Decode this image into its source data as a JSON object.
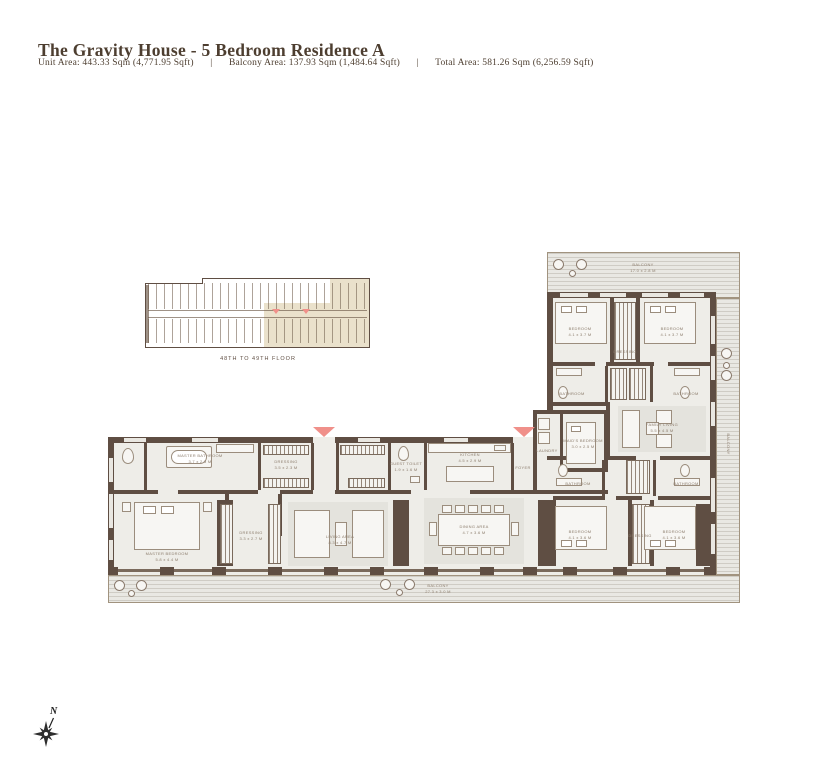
{
  "header": {
    "title": "The Gravity House - 5 Bedroom Residence A",
    "unit_area": "Unit Area: 443.33 Sqm (4,771.95 Sqft)",
    "balcony_area": "Balcony Area: 137.93 Sqm (1,484.64 Sqft)",
    "total_area": "Total Area: 581.26 Sqm (6,256.59 Sqft)",
    "separator": "|"
  },
  "key_plan": {
    "floor_label": "48TH TO 49TH FLOOR"
  },
  "compass": {
    "north_label": "N"
  },
  "colors": {
    "wall_brown": "#5f4e43",
    "entry_marker_pink": "#f0908a",
    "key_plan_highlight": "#eae1cb",
    "floor_fill": "#eeede8",
    "title_text": "#4d3e30",
    "room_label_text": "#8d7e6e"
  },
  "floor_plan": {
    "rooms": [
      {
        "name": "MASTER BATHROOM",
        "dims": "3.7 x 2.3 M"
      },
      {
        "name": "DRESSING",
        "dims": "3.5 x 2.3 M"
      },
      {
        "name": "GUEST TOILET",
        "dims": "1.9 x 1.6 M"
      },
      {
        "name": "KITCHEN",
        "dims": "4.5 x 2.9 M"
      },
      {
        "name": "FOYER",
        "dims": ""
      },
      {
        "name": "MASTER BEDROOM",
        "dims": "5.8 x 4.4 M"
      },
      {
        "name": "DRESSING",
        "dims": "3.3 x 2.7 M"
      },
      {
        "name": "LIVING AREA",
        "dims": "8.3 x 4.7 M"
      },
      {
        "name": "DINING AREA",
        "dims": "4.7 x 3.6 M"
      },
      {
        "name": "LAUNDRY",
        "dims": "2.3 x 1.7 M"
      },
      {
        "name": "MAID'S BEDROOM",
        "dims": "3.0 x 2.5 M"
      },
      {
        "name": "FAMILY LIVING",
        "dims": "5.5 x 4.5 M"
      },
      {
        "name": "BEDROOM",
        "dims": "4.1 x 3.7 M"
      },
      {
        "name": "DRESSING",
        "dims": ""
      },
      {
        "name": "BEDROOM",
        "dims": "4.1 x 3.7 M"
      },
      {
        "name": "BATHROOM",
        "dims": ""
      },
      {
        "name": "BATHROOM",
        "dims": ""
      },
      {
        "name": "BEDROOM",
        "dims": "4.1 x 3.6 M"
      },
      {
        "name": "DRESSING",
        "dims": ""
      },
      {
        "name": "BEDROOM",
        "dims": "4.1 x 3.6 M"
      },
      {
        "name": "BATHROOM",
        "dims": ""
      },
      {
        "name": "BATHROOM",
        "dims": ""
      }
    ],
    "balconies": [
      {
        "name": "BALCONY",
        "dims": "17.0 x 2.8 M"
      },
      {
        "name": "BALCONY",
        "dims": ""
      },
      {
        "name": "BALCONY",
        "dims": "27.3 x 3.0 M"
      }
    ]
  }
}
